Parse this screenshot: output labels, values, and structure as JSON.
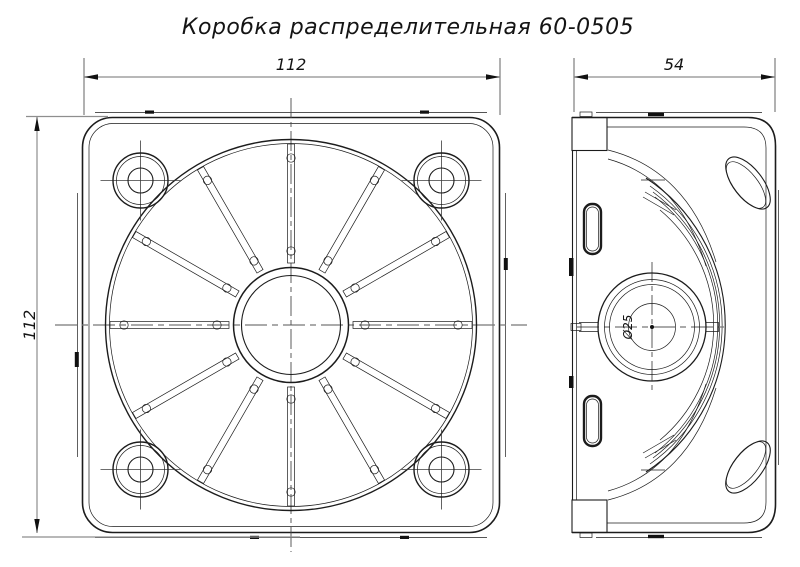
{
  "title": "Коробка распределительная 60-0505",
  "front_view": {
    "width_dim": "112",
    "height_dim": "112"
  },
  "side_view": {
    "depth_dim": "54",
    "boss_diameter_dim": "Ø25"
  },
  "colors": {
    "background": "#ffffff",
    "contour": "#1c1c1c",
    "dimension_line": "#8e8e8e",
    "centerline": "#4a4a4a",
    "text": "#141414"
  }
}
